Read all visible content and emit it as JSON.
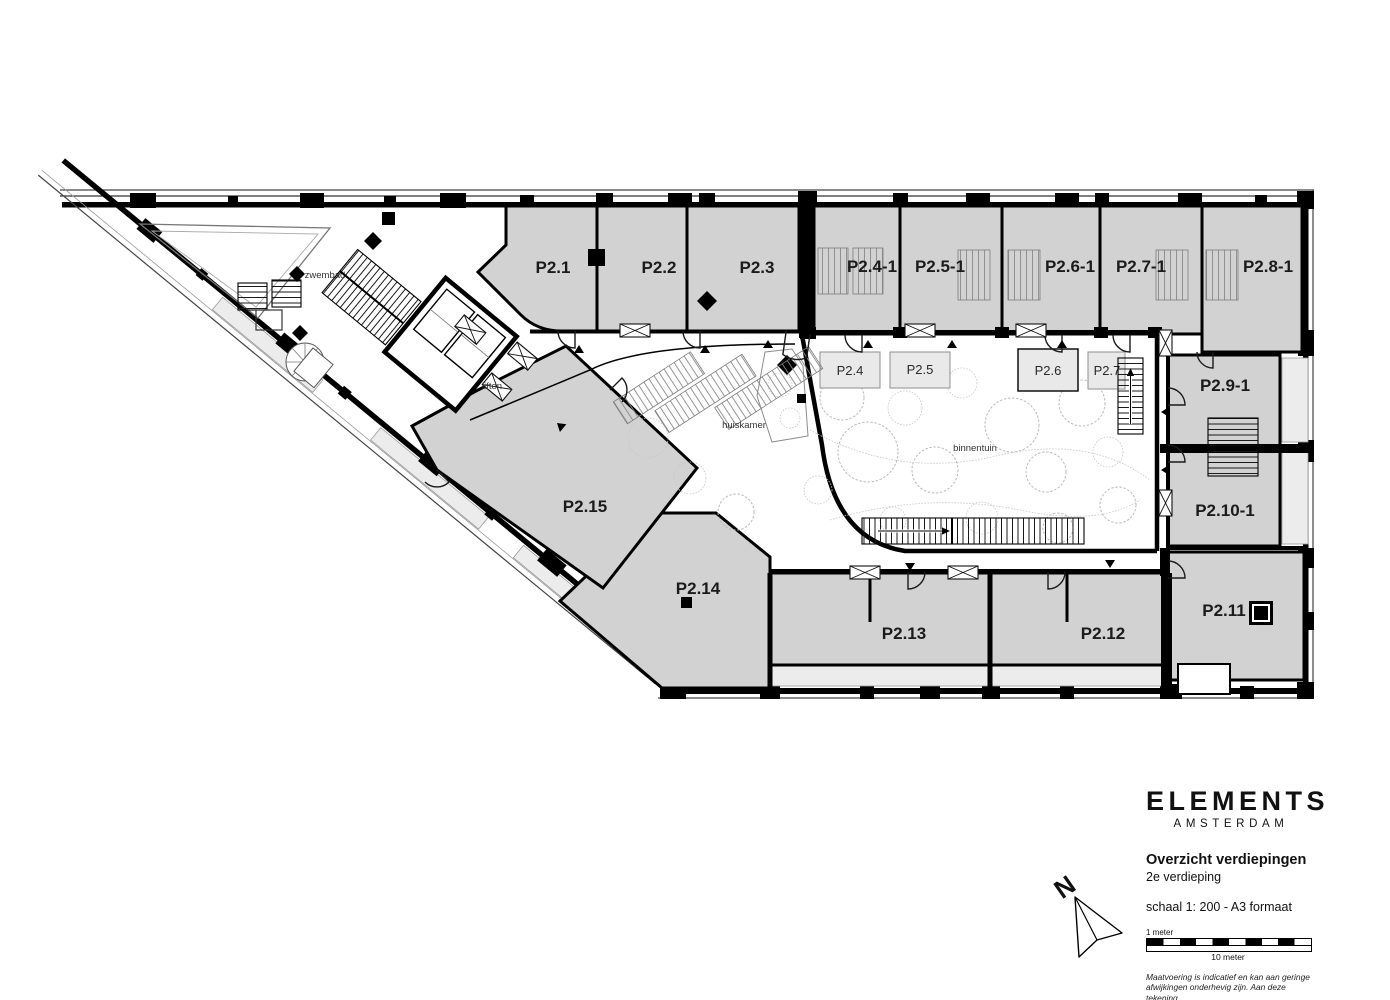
{
  "colors": {
    "unit_fill": "#d2d2d2",
    "balcony_fill": "#ececec",
    "wall": "#000000",
    "tree_stroke": "#b9b9b9"
  },
  "plan": {
    "units": {
      "p2_1": "P2.1",
      "p2_2": "P2.2",
      "p2_3": "P2.3",
      "p2_4_1": "P2.4-1",
      "p2_5_1": "P2.5-1",
      "p2_6_1": "P2.6-1",
      "p2_7_1": "P2.7-1",
      "p2_8_1": "P2.8-1",
      "p2_9_1": "P2.9-1",
      "p2_10_1": "P2.10-1",
      "p2_11": "P2.11",
      "p2_12": "P2.12",
      "p2_13": "P2.13",
      "p2_14": "P2.14",
      "p2_15": "P2.15"
    },
    "garden_units": {
      "p2_4": "P2.4",
      "p2_5": "P2.5",
      "p2_6": "P2.6",
      "p2_7": "P2.7"
    },
    "areas": {
      "pool": "zwembad",
      "lifts": "liften",
      "living_room": "huiskamer",
      "garden": "binnentuin"
    }
  },
  "north": {
    "label": "N"
  },
  "title_block": {
    "brand": "ELEMENTS",
    "brand_sub": "AMSTERDAM",
    "title": "Overzicht verdiepingen",
    "floor": "2e verdieping",
    "scale": "schaal 1: 200 - A3 formaat",
    "scale_small_label": "1 meter",
    "scale_big_label": "10 meter",
    "disclaimer_line1": "Maatvoering is indicatief en kan aan geringe",
    "disclaimer_line2": "afwijkingen onderhevig zijn. Aan deze tekening",
    "disclaimer_line3": "kunnen geen rechten worden ontleend."
  }
}
